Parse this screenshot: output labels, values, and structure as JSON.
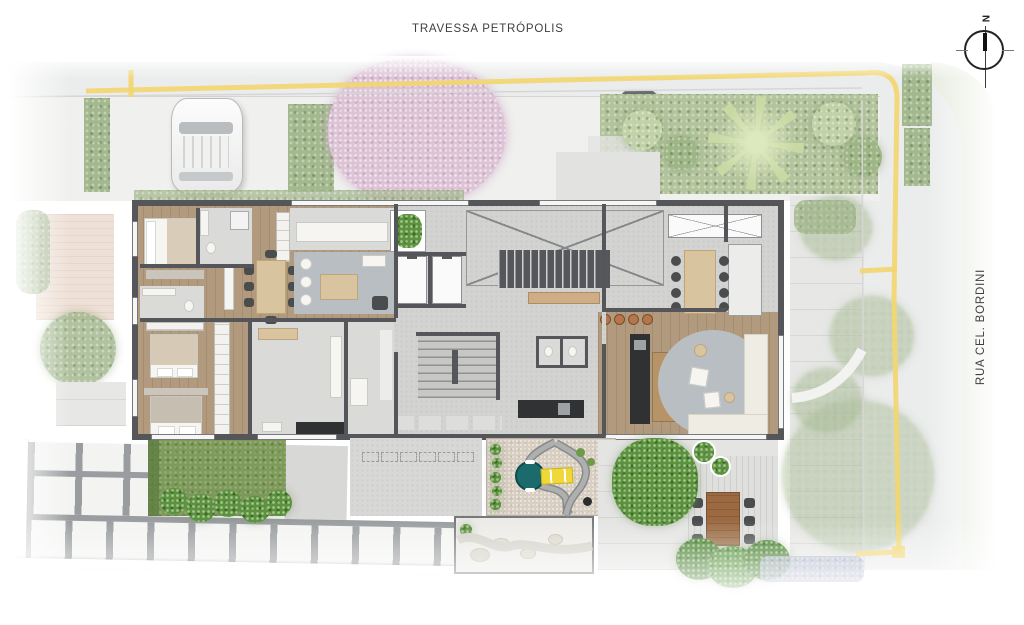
{
  "labels": {
    "street_top": "TRAVESSA PETRÓPOLIS",
    "street_right": "RUA CEL. BORDINI",
    "compass_north": "N"
  },
  "palette": {
    "street": "#ebecec",
    "sidewalk": "#f0f0ee",
    "road_marking": "#f2d671",
    "wall": "#54565a",
    "wood_floor": "#b19a7d",
    "concrete_floor": "#d3d4d2",
    "rug": "#b9bec2",
    "hedge_green": "#a3b88e",
    "lawn": "#7e9b59",
    "sand": "#d8cfc2",
    "pool_teal": "#1b6b6c",
    "slide_yellow": "#f0d838",
    "table_wood": "#d9c4a0",
    "stool_orange": "#b5764c",
    "tree_pink": "#dcc3d5",
    "deck_table": "#9b6a42"
  }
}
